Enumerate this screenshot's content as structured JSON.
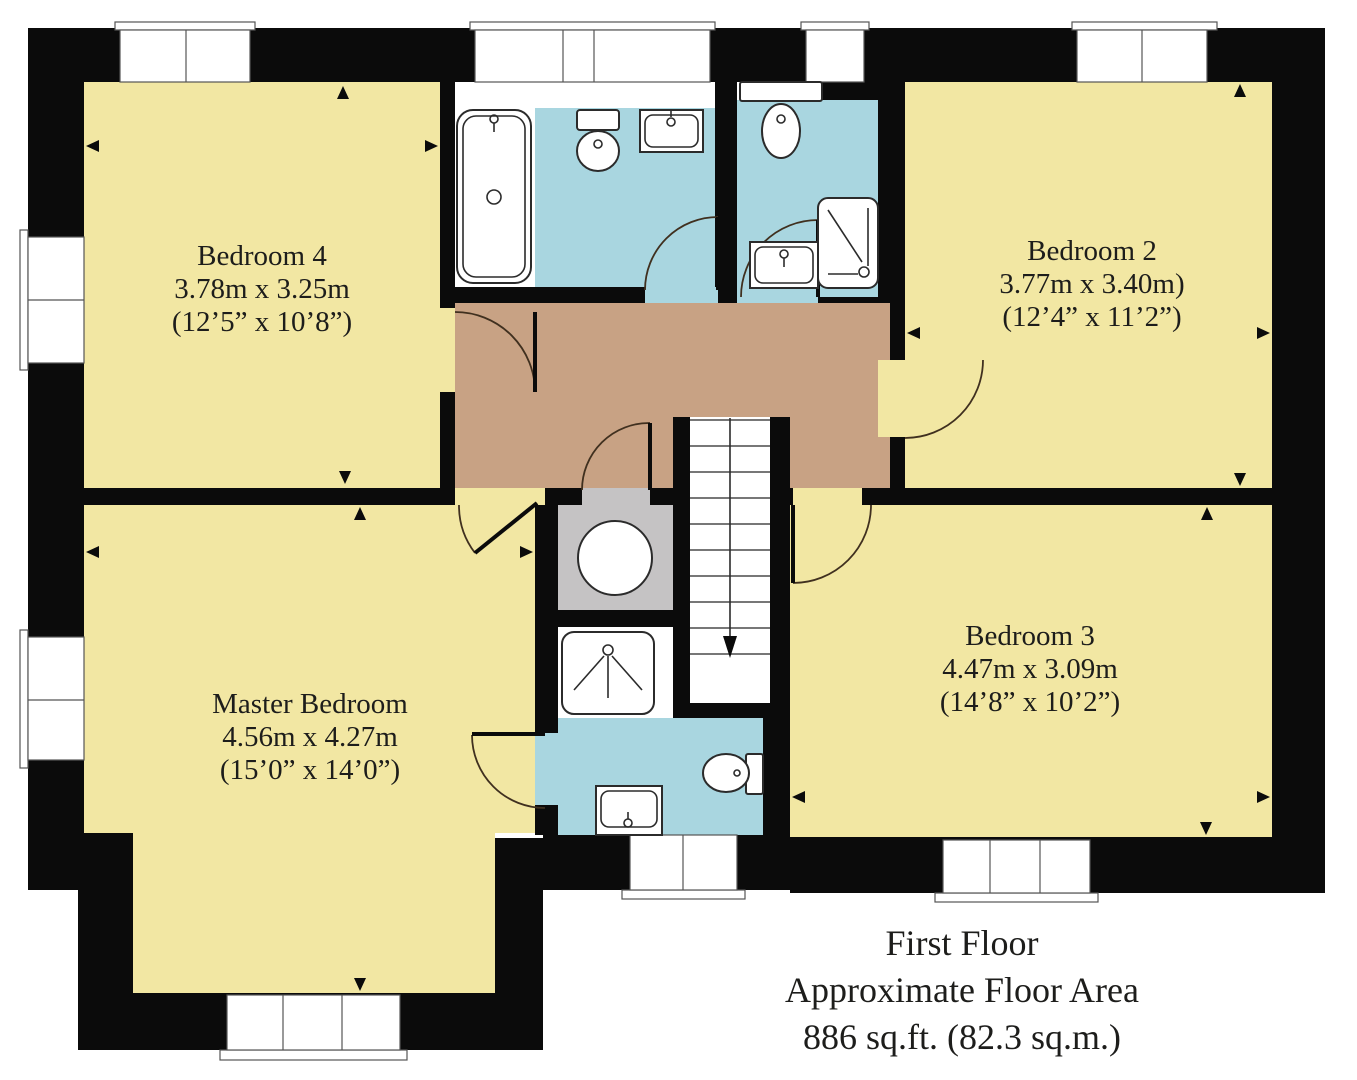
{
  "plan": {
    "footer": {
      "line1": "First Floor",
      "line2": "Approximate Floor Area",
      "line3": "886 sq.ft. (82.3 sq.m.)"
    },
    "rooms": [
      {
        "id": "bedroom-4",
        "name": "Bedroom 4",
        "metric": "3.78m x 3.25m",
        "imperial": "(12’5” x 10’8”)"
      },
      {
        "id": "bedroom-2",
        "name": "Bedroom 2",
        "metric": "3.77m x 3.40m)",
        "imperial": "(12’4” x 11’2”)"
      },
      {
        "id": "master-bedroom",
        "name": "Master Bedroom",
        "metric": "4.56m x 4.27m",
        "imperial": "(15’0” x 14’0”)"
      },
      {
        "id": "bedroom-3",
        "name": "Bedroom 3",
        "metric": "4.47m x 3.09m",
        "imperial": "(14’8” x 10’2”)"
      }
    ],
    "fixtures": [
      "bathtub",
      "toilet",
      "sink",
      "shower-cubicle",
      "shower-tray",
      "hot-water-cylinder",
      "staircase-down"
    ],
    "colors": {
      "wall": "#0b0b0b",
      "room": "#f2e7a3",
      "landing": "#c8a284",
      "bath": "#a9d6e0",
      "closet": "#c5c3c4",
      "text": "#1d1d1b",
      "bg": "#ffffff"
    }
  }
}
